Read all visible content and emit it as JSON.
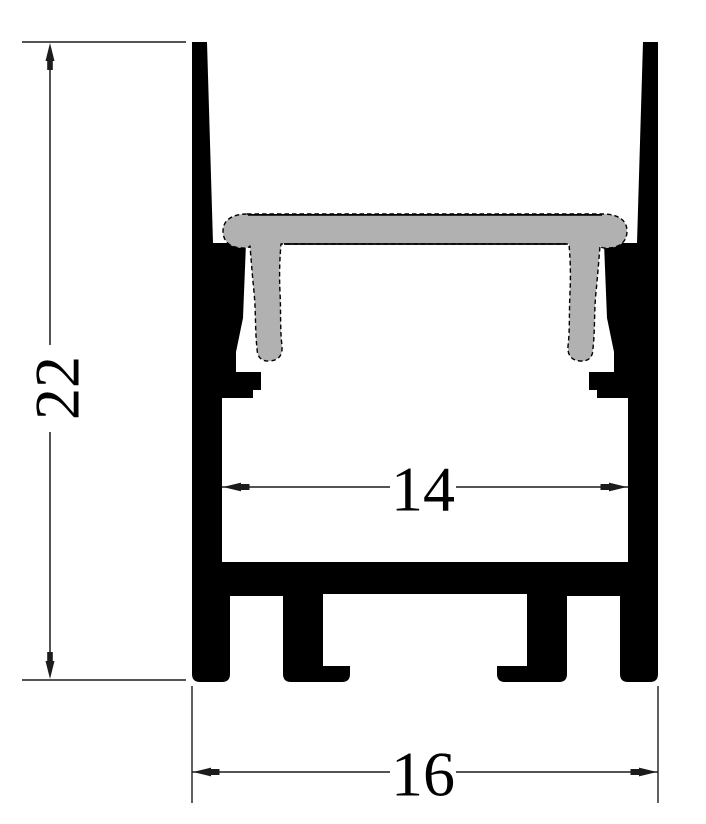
{
  "drawing": {
    "kind": "profile-cross-section"
  },
  "dimensions": {
    "overall_height": {
      "label": "22"
    },
    "inner_width": {
      "label": "14"
    },
    "overall_width": {
      "label": "16"
    }
  },
  "colors": {
    "profile_fill": "#000000",
    "diffuser_fill": "#b1b1b1",
    "diffuser_outline": "#000000",
    "dimension_line": "#1c1c1c",
    "dimension_text": "#000000",
    "background": "#ffffff"
  }
}
